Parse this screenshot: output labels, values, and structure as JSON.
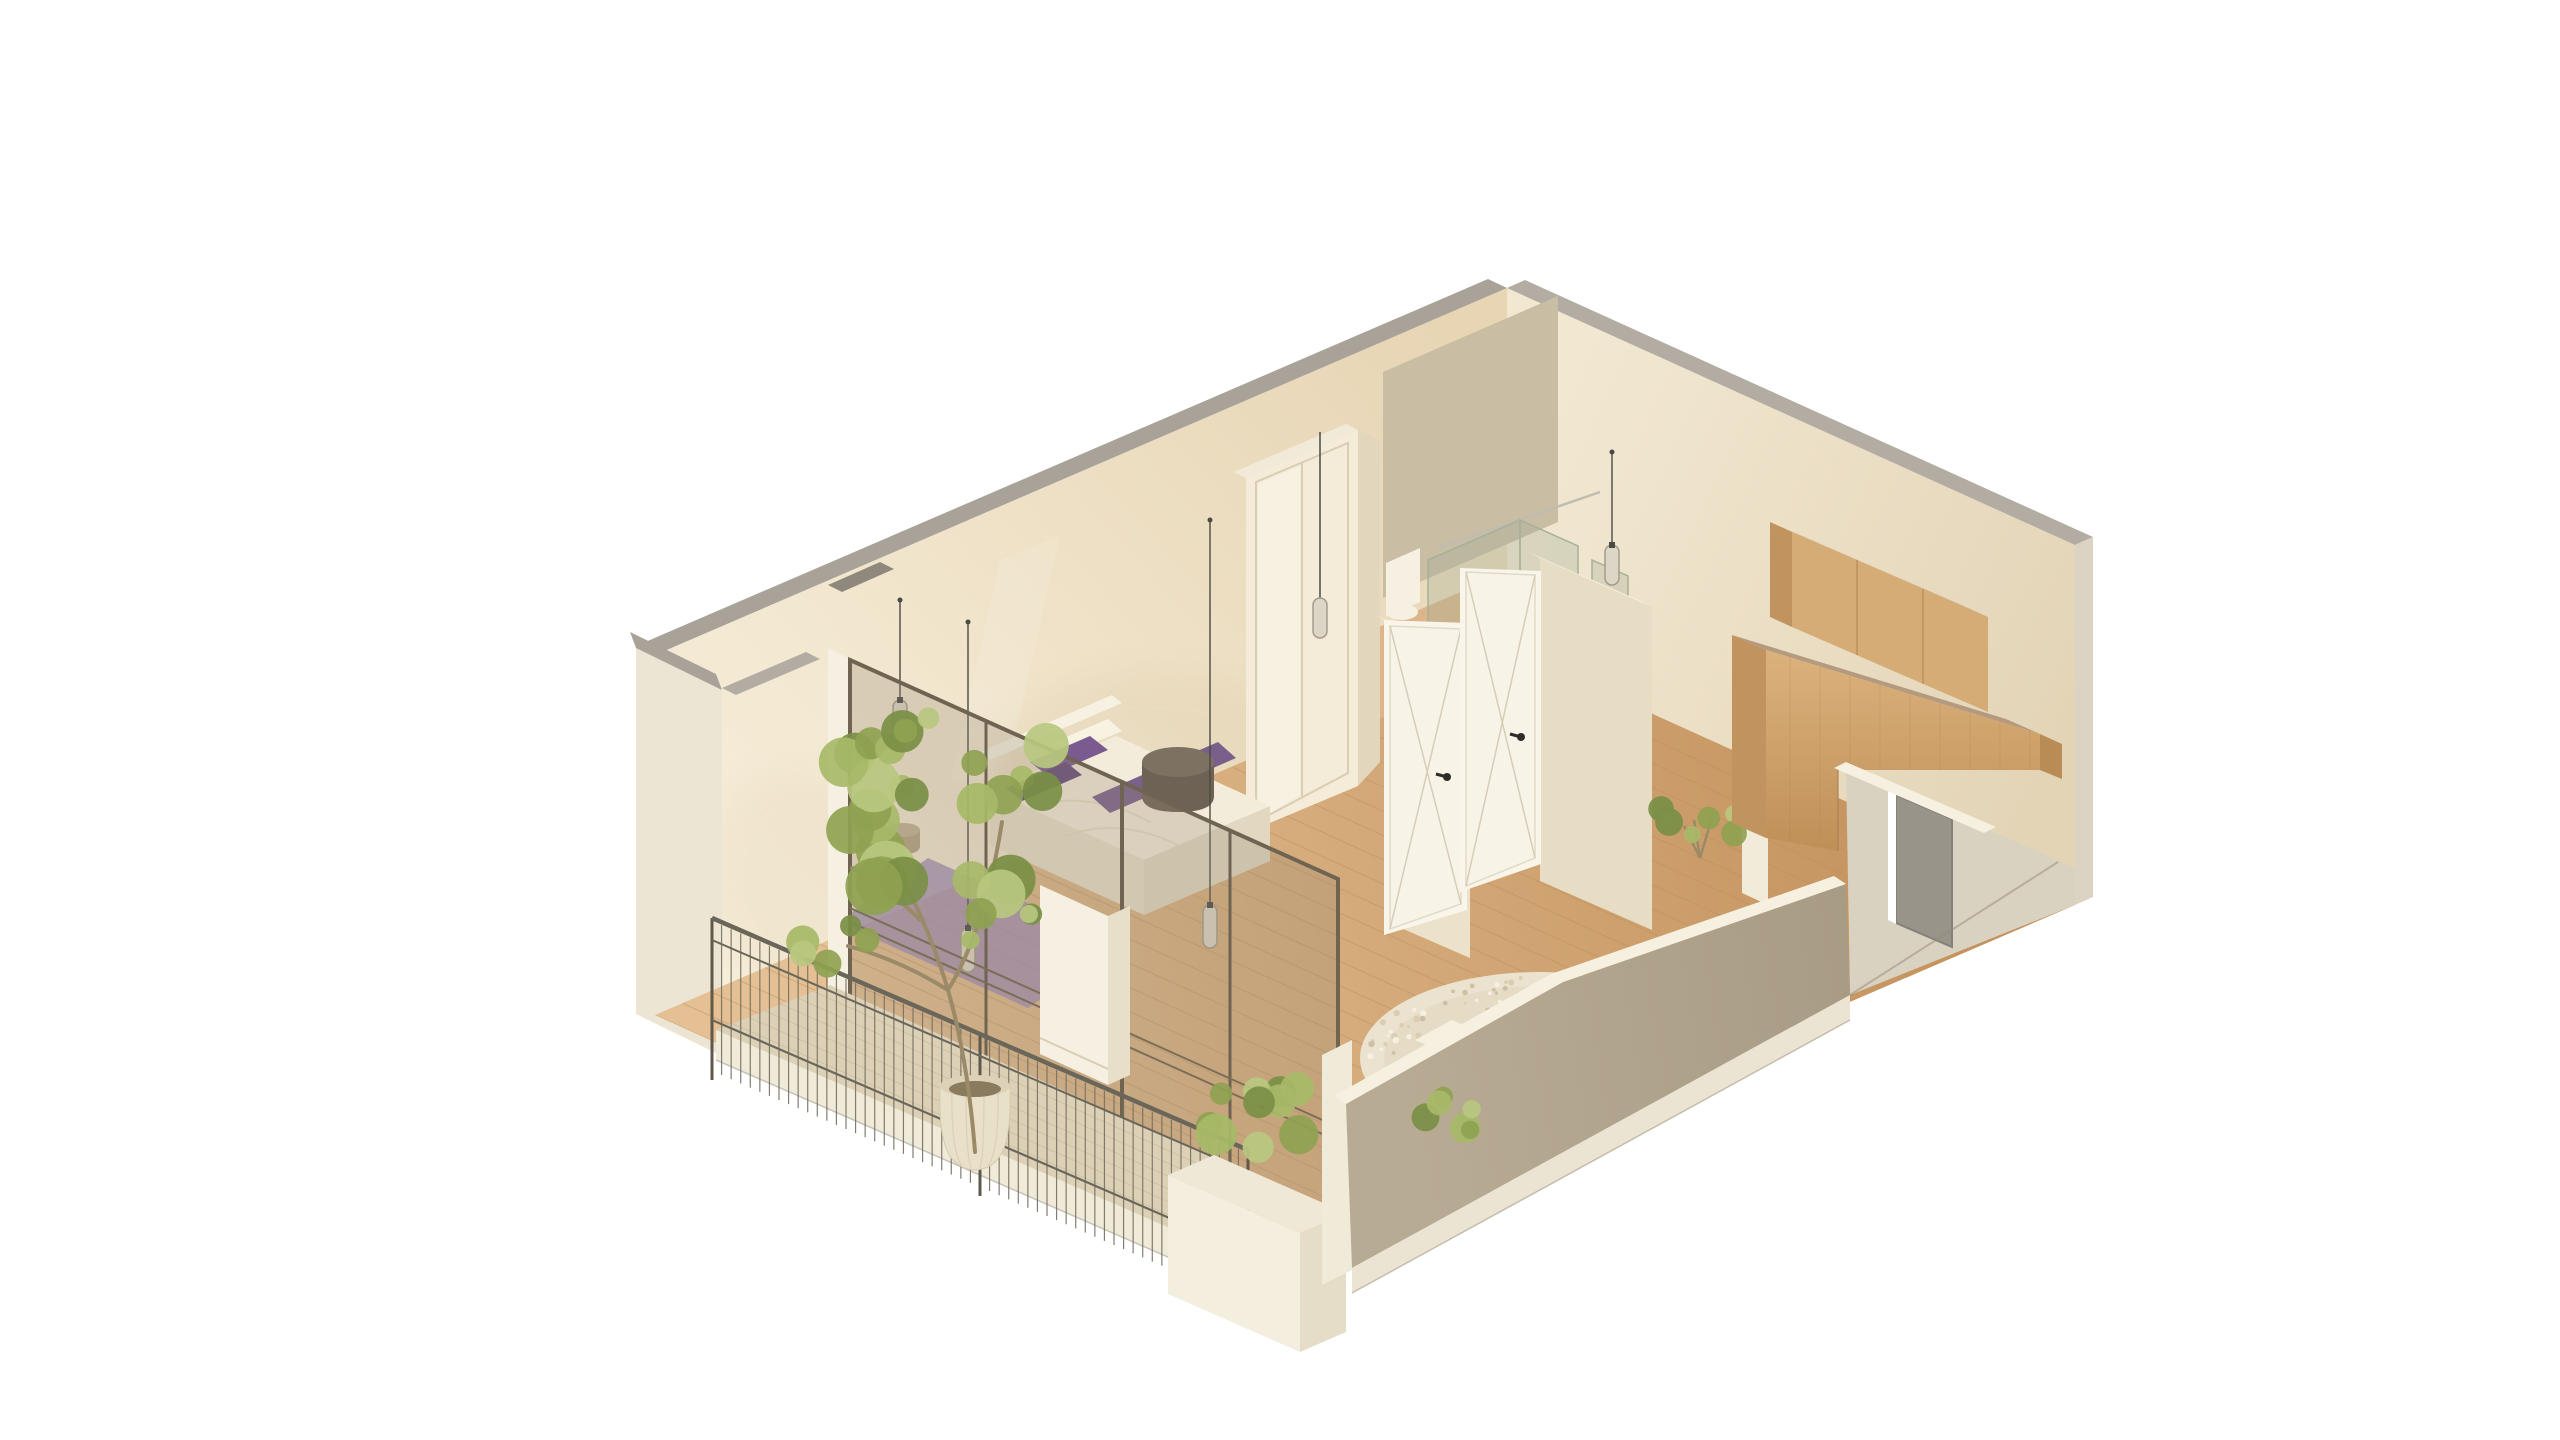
{
  "meta": {
    "kind": "isometric-3d-floor-plan-render",
    "background": "#ffffff",
    "no_visible_text": true
  },
  "scene": {
    "rooms": [
      {
        "name": "bedroom",
        "objects": [
          "double-bed",
          "purple-pillows",
          "purple-throw",
          "purple-area-rug",
          "woven-basket",
          "dark-pouf",
          "sliding-door-wardrobe",
          "pendant-lamps"
        ]
      },
      {
        "name": "bathroom",
        "objects": [
          "walk-in-shower-glass",
          "tiled-wall",
          "shower-tray",
          "laundry-bin",
          "purple-bath-mat",
          "toilet",
          "washbasin-cabinet",
          "pendant-lamp"
        ]
      },
      {
        "name": "hallway",
        "objects": [
          "white-door-open-1",
          "white-door-open-2",
          "partition-walls"
        ]
      },
      {
        "name": "living-kitchen",
        "objects": [
          "wood-upper-cabinets",
          "wood-counter-bridge",
          "round-shaggy-rug",
          "indoor-plant",
          "entry-gray-door"
        ]
      },
      {
        "name": "balcony",
        "objects": [
          "wood-deck",
          "metal-railing",
          "potted-tree",
          "white-planter-shrub",
          "terrace-shrub",
          "glazed-sliding-doors"
        ]
      }
    ]
  },
  "palette": {
    "background": "#ffffff",
    "cut_gray": "#a8a298",
    "cut_gray2": "#b2aca2",
    "cap_dark": "#8e887d",
    "cut_cream": "#f1ead8",
    "cut_cream2": "#f6f0e0",
    "outer_light": "#ece5d4",
    "outer_shadow": "#dcd4c2",
    "entry_wall": "#d9d2c1",
    "fascia": "#ebe4d2",
    "fascia_light": "#f0ead9",
    "sill_white": "#f2ecdb",
    "pier_white": "#f5f0e2",
    "pier_side": "#e7dfca",
    "tile": "#c9bda4",
    "wall_warm_1": "#f8f0dd",
    "wall_warm_2": "#e7d5b4",
    "wall_right_1": "#f2e8d2",
    "wall_right_2": "#e3d4b6",
    "floor_1": "#e4c094",
    "floor_2": "#c3915c",
    "floor_seam": "#b98e5f",
    "bath_floor": "#dcb68a",
    "taupe_1": "#b8ab93",
    "taupe_2": "#a4977f",
    "taupe_line": "#968a74",
    "deck": "#dcd1b6",
    "deck_seam": "#c8bc9e",
    "rail_dark": "#6b665a",
    "rail_mid": "#767061",
    "rail_post": "#5f594c",
    "planter_white": "#f4eedf",
    "planter_side": "#e6ddc9",
    "planter_top": "#efe8d6",
    "pot": "#e9e0ca",
    "pot_rib": "#d5c9ae",
    "pot_top": "#ddd2b8",
    "soil": "#8a7a5e",
    "trunk": "#9b8a68",
    "green_1": "#8fa251",
    "green_2": "#a7ba68",
    "green_3": "#7a8f45",
    "green_4": "#b9c87f",
    "glass_tint": "rgba(150,138,115,0.28)",
    "frame_bronze": "#6f6452",
    "frame_rail": "#7a6e58",
    "shower_glass": "rgba(158,172,150,0.30)",
    "shower_frame": "#a8b098",
    "chrome": "#c0bcb0",
    "wardrobe_front": "#f4ecd9",
    "wardrobe_side": "#e2d7bd",
    "frame_line": "#d9cdb3",
    "part_face": "#ece2cb",
    "part_face2": "#e7dcc4",
    "door_white": "#f8f3e7",
    "door_edge": "#e2dac8",
    "door_line": "#d6cdb6",
    "door_frame": "#faf5ea",
    "handle": "#2e2c28",
    "door_gray": "#98948a",
    "door_gray_edge": "#85817a",
    "wood_top": "#c9ad85",
    "wood_top2": "#b49a7e",
    "wood_front": "#d6ac76",
    "wood_front_2": "#dcb27c",
    "wood_front_3": "#bd8c55",
    "wood_side": "#c1945f",
    "wood_side2": "#ba8c55",
    "wood_seam": "#a87f4e",
    "bed_top": "#f4ecda",
    "bed_side": "#e9e0ca",
    "bed_side2": "#e2d8c2",
    "bed_white": "#f7f1e2",
    "fold": "#e5dac2",
    "pillow_white": "#f8f2e3",
    "pillow_purple": "#7b5a90",
    "pillow_purple_dark": "#654a7c",
    "throw_purple": "#6f5586",
    "rug_purple": "#a08cb4",
    "rug_base": "#ebe2cf",
    "rug_inner": "#e3d9c0",
    "speckle_1": "#d8cbae",
    "speckle_2": "#f7f2e4",
    "speckle_3": "#c9bca0",
    "pouf": "#6e6254",
    "pouf_top": "#7d7162",
    "basket": "#b3a384",
    "basket_top": "#c2b396",
    "bin": "#a39b8b",
    "bin_top": "#b0a898",
    "bath_mat": "#7e6f9b",
    "toilet_white": "#f6f0e2",
    "cord": "#4a4a46",
    "lamp_glass": "#ddd6c6",
    "lamp_stroke": "#a39c8a",
    "shadow_warm": "#cdb68e",
    "white_fin": "#f1ebd9",
    "tray_white": "#f4eedd",
    "tray_edge": "#e0d8c4"
  }
}
